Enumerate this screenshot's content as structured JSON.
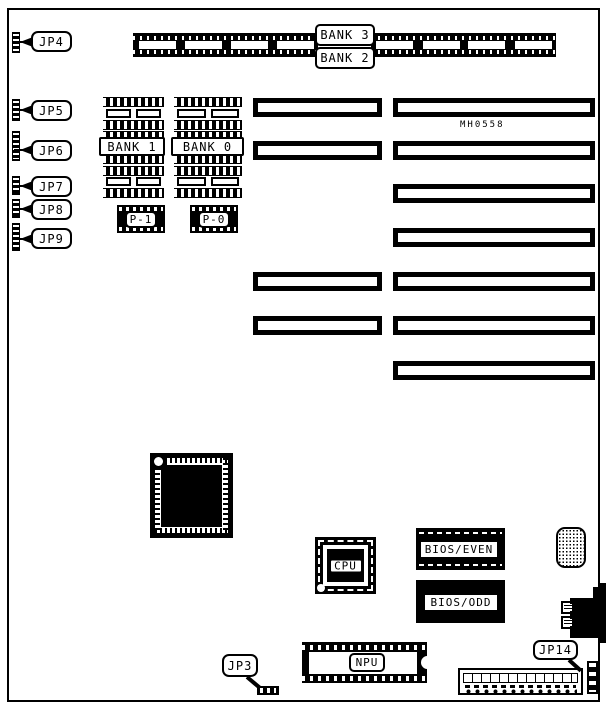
{
  "board": {
    "part_number": "MH0558",
    "jumpers": {
      "jp3": "JP3",
      "jp4": "JP4",
      "jp5": "JP5",
      "jp6": "JP6",
      "jp7": "JP7",
      "jp8": "JP8",
      "jp9": "JP9",
      "jp14": "JP14"
    },
    "memory_banks": {
      "bank3": "BANK 3",
      "bank2": "BANK 2",
      "bank1": "BANK 1",
      "bank0": "BANK 0"
    },
    "parity": {
      "p1": "P-1",
      "p0": "P-0"
    },
    "chips": {
      "cpu": "CPU",
      "npu": "NPU",
      "bios_even": "BIOS/EVEN",
      "bios_odd": "BIOS/ODD"
    },
    "colors": {
      "ink": "#000000",
      "paper": "#ffffff"
    }
  }
}
